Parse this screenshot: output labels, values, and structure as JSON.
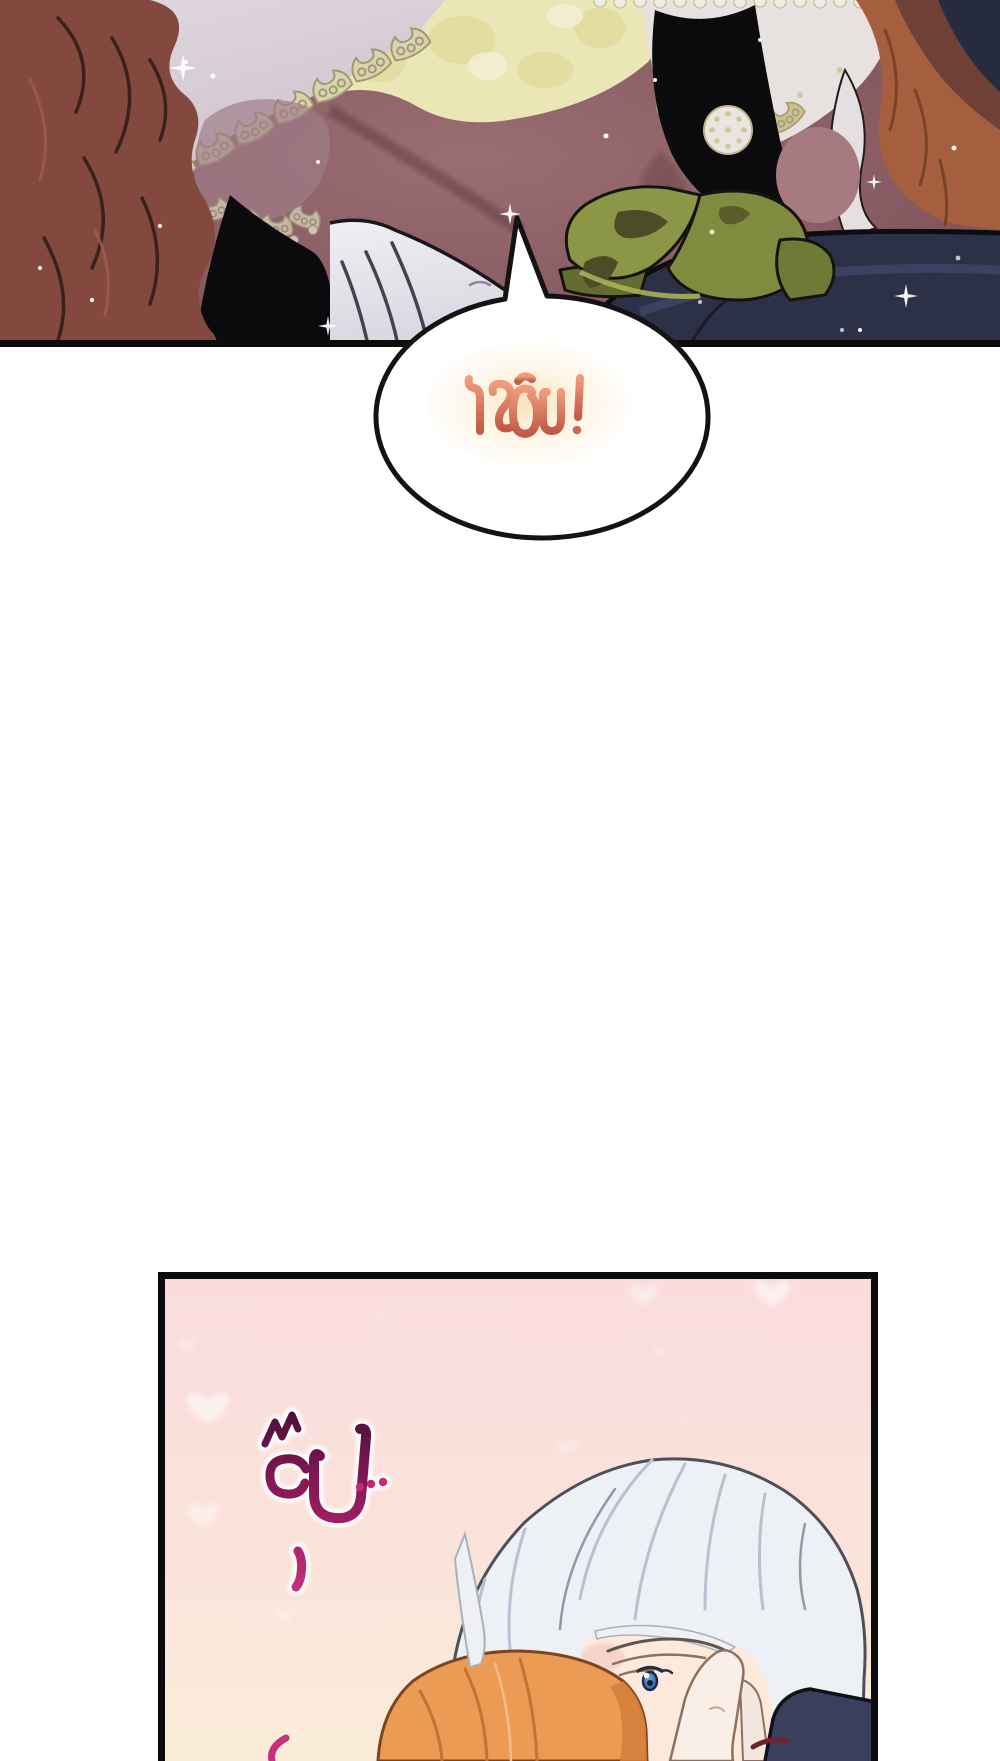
{
  "page": {
    "kind": "webtoon comic page segment",
    "background_color": "#ffffff"
  },
  "top_panel": {
    "alt": "Close-up panel: red-haired woman in a lace gown with yellow lace bodice, green ribbon and white glove against dark navy fabric",
    "border_color": "#0c0c0c",
    "colors": {
      "background_mauve": "#875c62",
      "hair_auburn": "#83493f",
      "hair_copper": "#a65f3e",
      "lace_cream": "#e7e1e0",
      "bodice_yellow": "#ebe6b5",
      "ribbon_green": "#8b9647",
      "fabric_navy": "#2c3148",
      "glove_white": "#e9e7ee"
    }
  },
  "speech_bubble": {
    "text": "โรอัน!",
    "text_color": "#dd7b5f",
    "glow_color": "#fbe4bc",
    "bubble_fill": "#ffffff",
    "outline_color": "#131313"
  },
  "bottom_panel": {
    "alt": "Pink panel with hearts: silver-haired man with blue eye being kissed on the cheek by an orange-haired person, a hand touching his face",
    "sfx_text": "จุ๊บ...",
    "sfx_color_dark": "#49103a",
    "sfx_color_bright": "#c12a74",
    "background_top": "#fadcdd",
    "background_bottom": "#fbecd9",
    "border_color": "#0b0b0b",
    "colors": {
      "hair_silver": "#edf0f4",
      "skin": "#fdeadc",
      "eye_blue": "#377cc0",
      "hair_orange": "#ec9b54",
      "sleeve_navy": "#3a3f5e"
    }
  }
}
